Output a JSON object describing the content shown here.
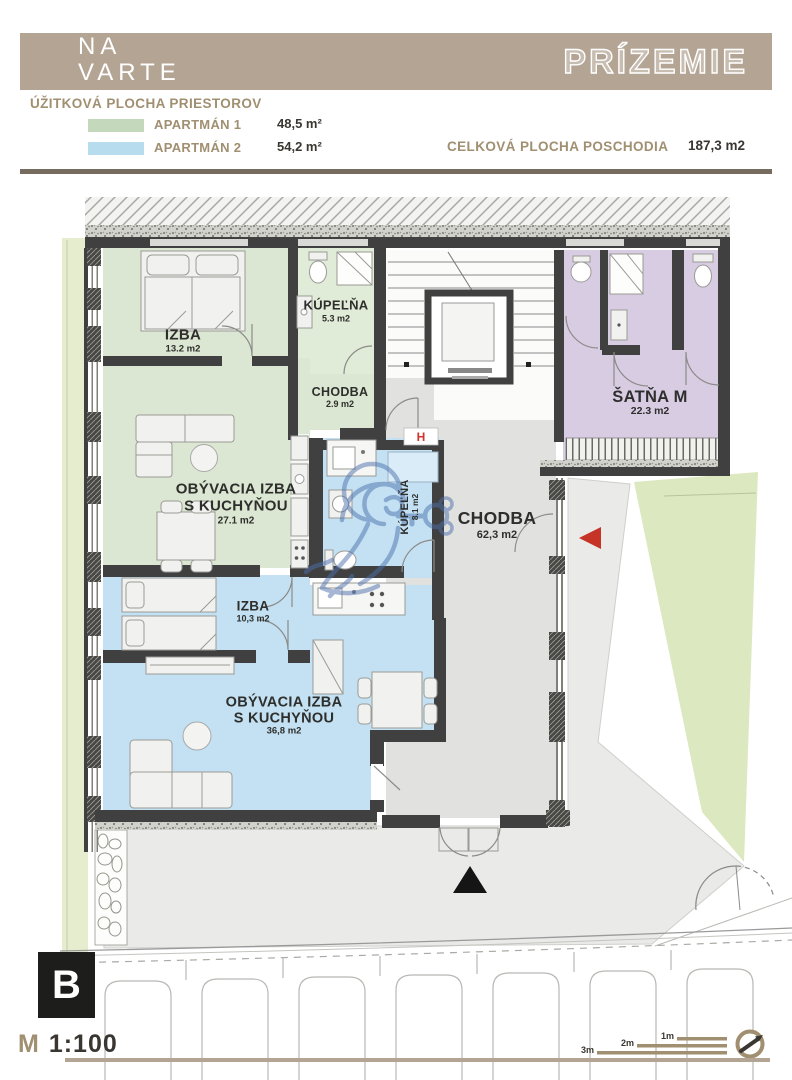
{
  "header": {
    "logo_line1": "NA",
    "logo_line2": "VARTE",
    "title": "PRÍZEMIE"
  },
  "legend": {
    "title": "ÚŽITKOVÁ PLOCHA PRIESTOROV",
    "items": [
      {
        "label": "APARTMÁN 1",
        "area": "48,5 m²",
        "color": "#c4d9bc"
      },
      {
        "label": "APARTMÁN 2",
        "area": "54,2 m²",
        "color": "#b6dcee"
      }
    ],
    "total_label": "CELKOVÁ PLOCHA POSCHODIA",
    "total_value": "187,3 m2"
  },
  "rooms": {
    "izba1": {
      "name": "IZBA",
      "area": "13.2 m2"
    },
    "kupelna1": {
      "name": "KÚPEĽŇA",
      "area": "5.3 m2"
    },
    "chodba1": {
      "name": "CHODBA",
      "area": "2.9 m2"
    },
    "obyvacia1": {
      "name_line1": "OBÝVACIA IZBA",
      "name_line2": "S KUCHYŇOU",
      "area": "27.1 m2"
    },
    "kupelna2": {
      "name": "KÚPEĽŇA",
      "area": "8.1 m2"
    },
    "chodba_main": {
      "name": "CHODBA",
      "area": "62,3 m2"
    },
    "satna": {
      "name": "ŠATŇA M",
      "area": "22.3 m2"
    },
    "izba2": {
      "name": "IZBA",
      "area": "10,3 m2"
    },
    "obyvacia2": {
      "name_line1": "OBÝVACIA IZBA",
      "name_line2": "S KUCHYŇOU",
      "area": "36,8 m2"
    }
  },
  "markers": {
    "hydrant": "H",
    "section": "B"
  },
  "footer": {
    "scale_prefix": "M",
    "scale_value": "1:100",
    "scale_bar_labels": [
      "1m",
      "2m",
      "3m"
    ]
  },
  "colors": {
    "header_bar": "#b3a494",
    "accent_text": "#a08f70",
    "apartment1_fill": "#dbe7d2",
    "apartment2_fill": "#c3e1f2",
    "satna_fill": "#d8cce3",
    "hall_fill": "#e1e1df",
    "wall": "#404040",
    "lawn": "#dce8c0",
    "watermark_blue": "#4d71ad",
    "marker_red": "#c63327"
  }
}
